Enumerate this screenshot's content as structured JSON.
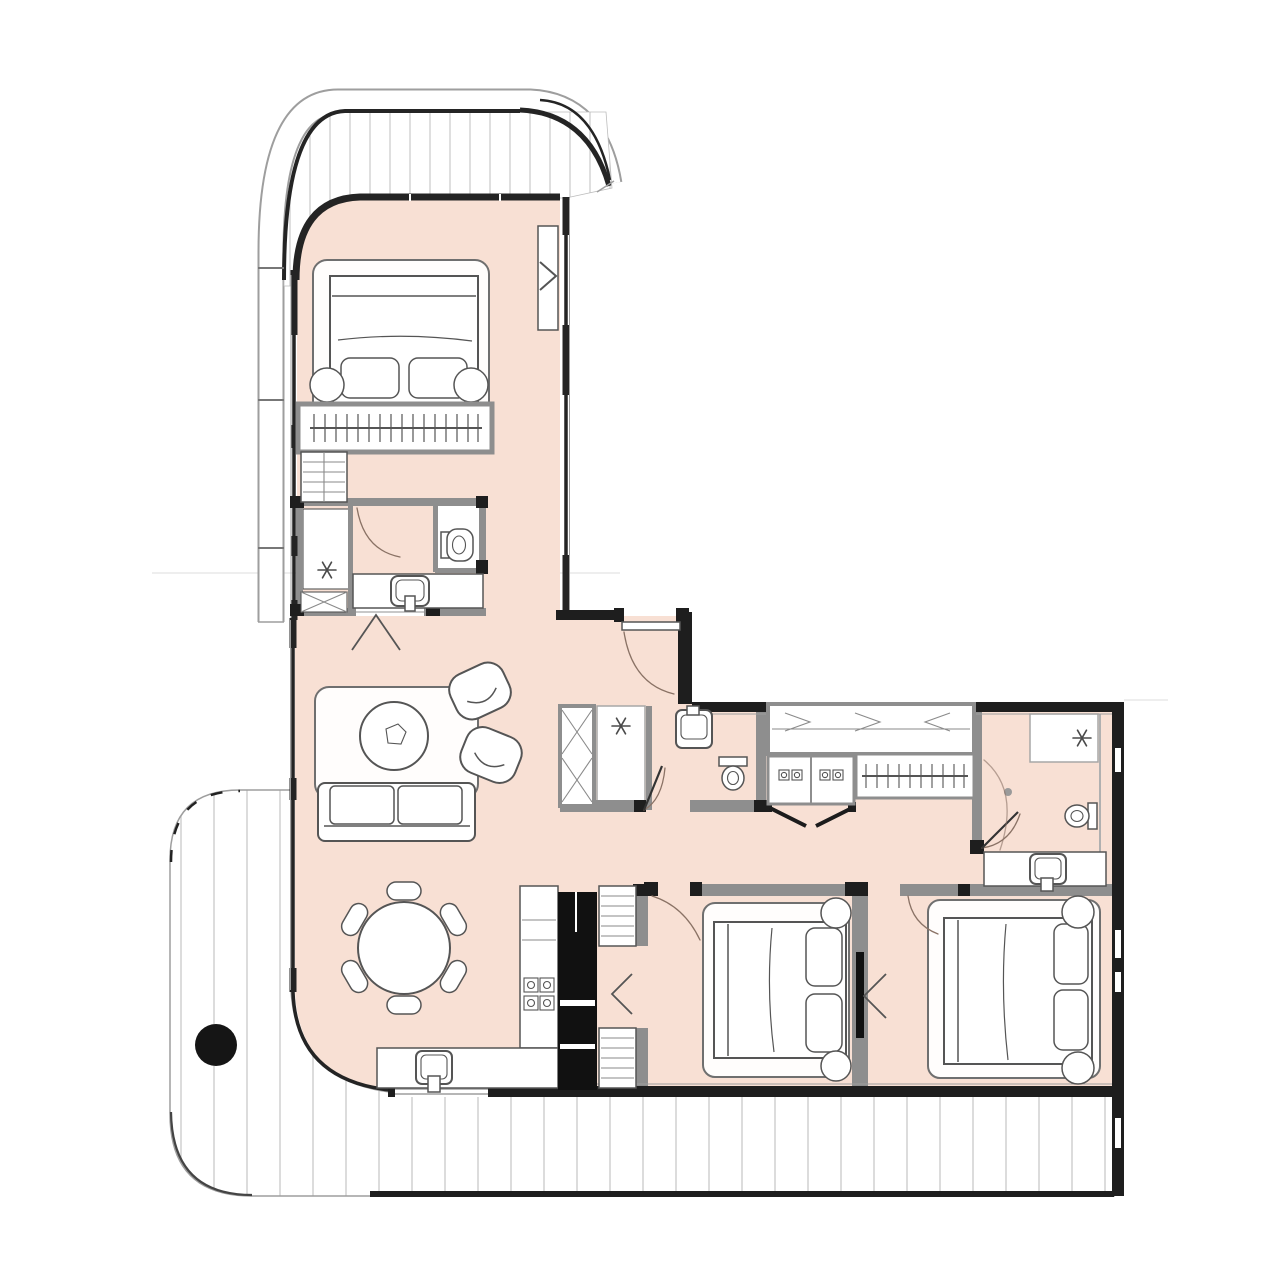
{
  "meta": {
    "label": "Rendered 2D apartment floor plan, top-down view, no text labels"
  },
  "colors": {
    "canvas": "#ffffff",
    "floor": "#f8e0d4",
    "wallDark": "#1e1e1e",
    "wallGray": "#8e8e8e",
    "line": "#555555",
    "lineLight": "#9e9e9e",
    "hatch": "#c9c9c9",
    "sketch": "#8a7265",
    "column": "#151515"
  },
  "plan": {
    "shape": "L-shaped unit; top wing bedroom suite, lower wing living-kitchen and two bedrooms",
    "balconies": [
      {
        "id": "balcony-top",
        "style": "curved railing band, vertical hatch decking"
      },
      {
        "id": "balcony-wraparound",
        "style": "curved corners, vertical hatch decking, round structural column"
      }
    ],
    "rooms": [
      {
        "id": "bedroom-1",
        "furniture": [
          "area-rug",
          "double-bed",
          "two-pillows",
          "two-round-nightstands",
          "wardrobe-hanging-rail",
          "shelf-unit",
          "wall-tv-unit"
        ]
      },
      {
        "id": "ensuite-bathroom-1",
        "furniture": [
          "shower",
          "toilet",
          "vanity-with-sink",
          "x-cabinet"
        ]
      },
      {
        "id": "living-dining-room",
        "furniture": [
          "area-rug",
          "round-coffee-table",
          "armchair",
          "armchair",
          "sofa",
          "round-dining-table",
          "six-dining-chairs"
        ]
      },
      {
        "id": "kitchen",
        "furniture": [
          "counter-run",
          "four-burner-cooktop",
          "kitchen-sink",
          "tall-black-unit",
          "appliance-tower",
          "appliance-tower"
        ]
      },
      {
        "id": "hallway",
        "furniture": [
          "tall-x-cabinet",
          "service-shaft",
          "double-entry-doors"
        ]
      },
      {
        "id": "bathroom-2",
        "furniture": [
          "wall-basin",
          "toilet"
        ]
      },
      {
        "id": "laundry-closet",
        "furniture": [
          "overhead-cabinet",
          "two-appliance-bays",
          "bifold-doors"
        ]
      },
      {
        "id": "walk-in-wardrobe",
        "furniture": [
          "hanging-rail"
        ]
      },
      {
        "id": "bedroom-2",
        "furniture": [
          "area-rug",
          "double-bed",
          "two-pillows",
          "two-round-nightstands",
          "pocket-door"
        ]
      },
      {
        "id": "bedroom-3",
        "furniture": [
          "area-rug",
          "double-bed",
          "two-pillows",
          "two-round-nightstands"
        ]
      },
      {
        "id": "ensuite-bathroom-3",
        "furniture": [
          "shower",
          "toilet",
          "vanity-with-sink"
        ]
      }
    ],
    "symbols": {
      "asterisk": "shower / ceiling point marker",
      "chevron": "door or opening marker",
      "vertical-hatch": "balcony decking",
      "x-pattern": "storage cabinet",
      "tick-rail": "wardrobe hanging rail"
    }
  }
}
